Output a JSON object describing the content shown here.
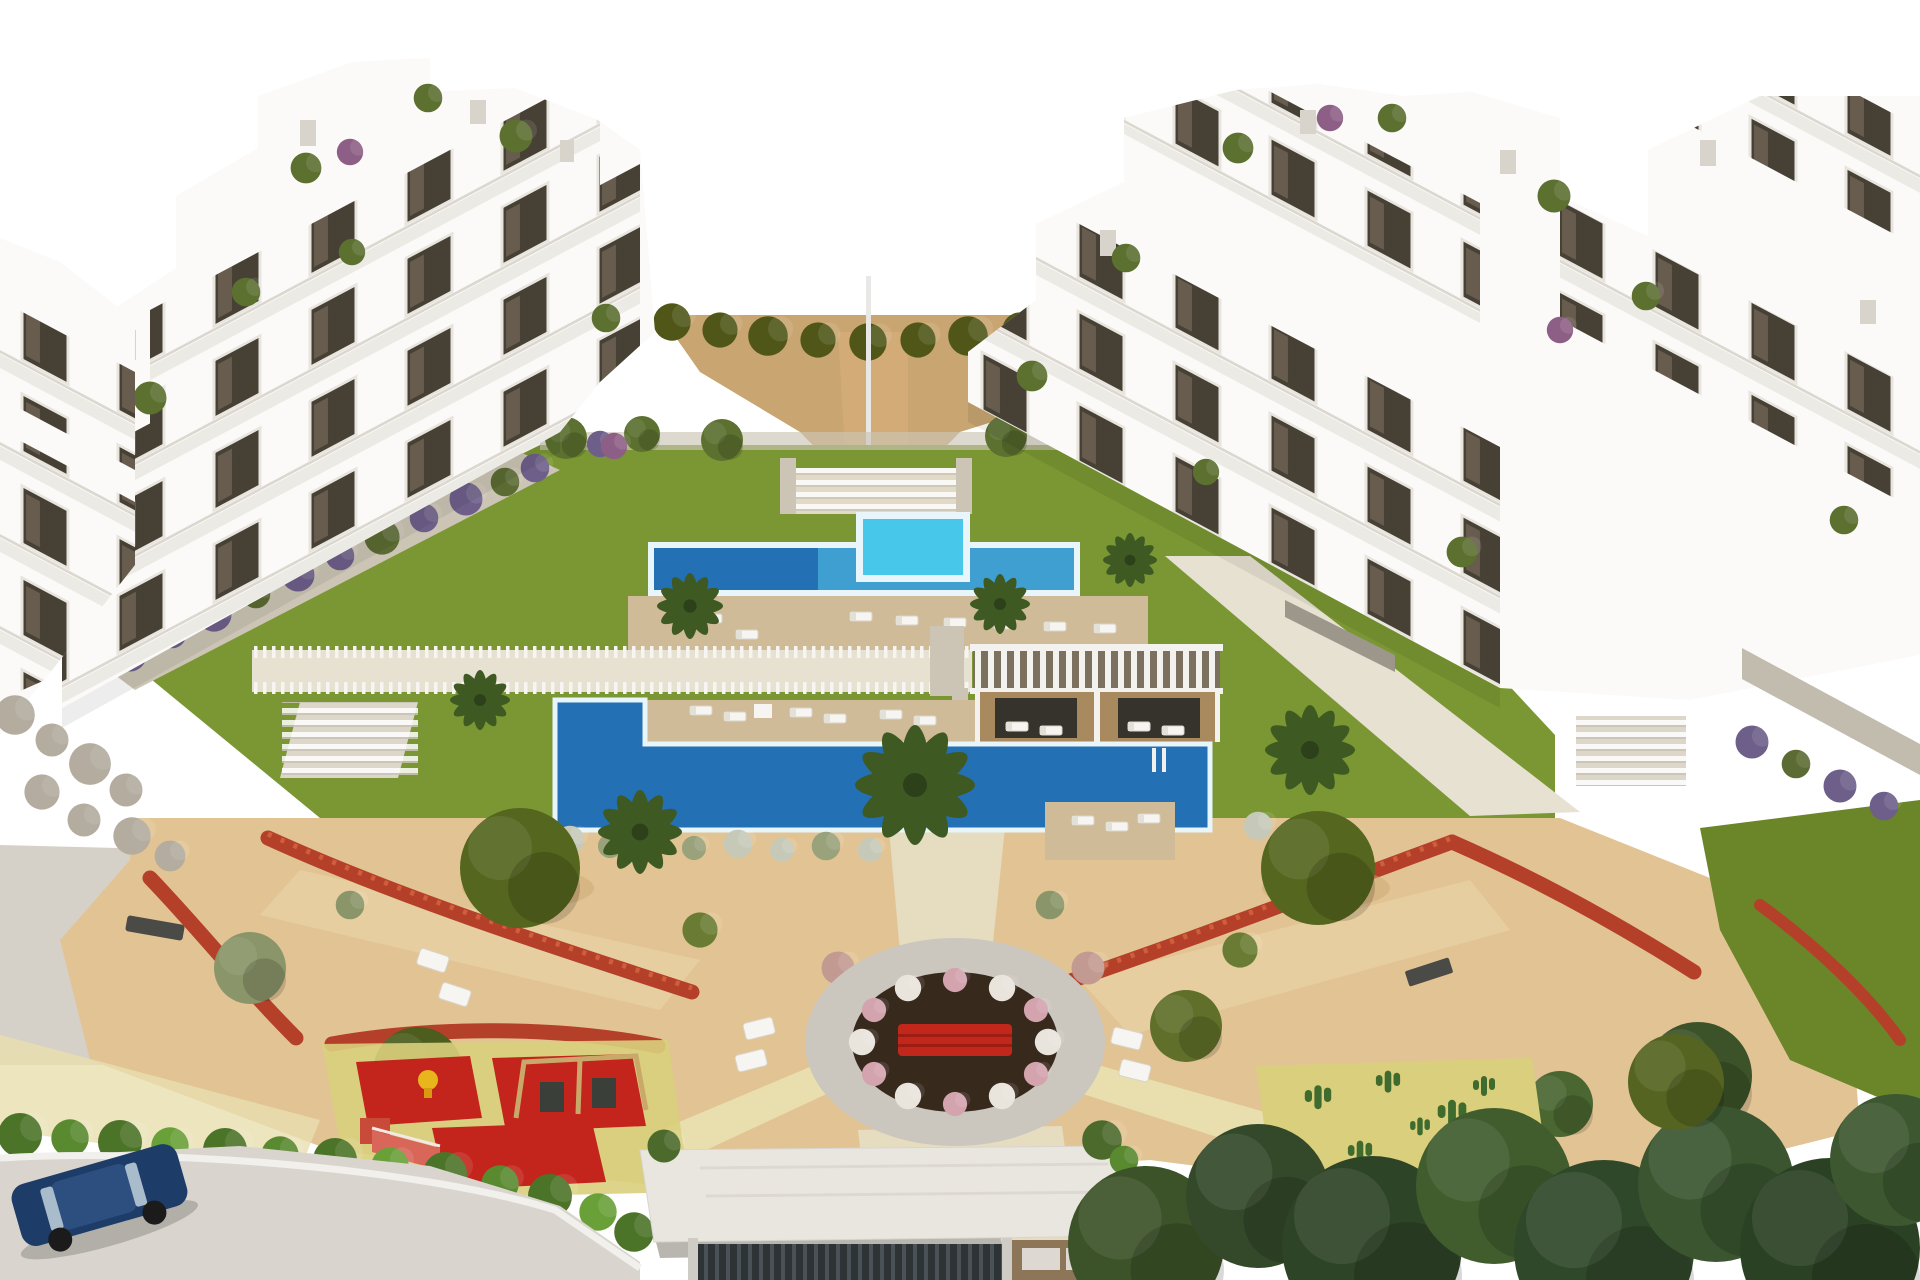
{
  "scene": {
    "type": "3d-architectural-render",
    "view": "aerial",
    "description": "Modern white apartment complex with central pool courtyard, lawns, sandy gardens, circular plaza, children playground, cactus garden, entrance gate and access road",
    "elements": [
      "left apartment building",
      "far-left apartment building",
      "right apartment building",
      "sand hill with olive hedge",
      "lap pool with raised spa",
      "sun deck with loungers",
      "white picket walkway",
      "white slatted pergola",
      "wooden cabanas",
      "main swimming pool",
      "courtyard lawn",
      "lavender hedge walls",
      "sandy park",
      "red flowering hedges",
      "olive trees",
      "palm trees",
      "circular plaza with red bench",
      "white lounge chairs",
      "children playground with red mats, swings and slide",
      "cactus garden",
      "entrance gate with white canopy",
      "access road with curb",
      "parked dark blue car",
      "bottom-right tree grove"
    ]
  },
  "palette": {
    "sky": "#ffffff",
    "building_white": "#fbfaf8",
    "building_shade": "#eceae4",
    "window_dark": "#474034",
    "sand_hill": "#c9a571",
    "hedge_olive": "#4f5618",
    "lawn_green": "#7a9733",
    "lawn_dark": "#6a8629",
    "pool_blue": "#2470b4",
    "pool_mid": "#3f9fd0",
    "spa_cyan": "#47c8ea",
    "pool_rim": "#e8f5fb",
    "deck_tan": "#cfbb97",
    "walkway_pale": "#e7e1d2",
    "stone_gray": "#ccc5b5",
    "pergola_shadow": "#7c715f",
    "slat_white": "#f4f2ee",
    "cabana_brown": "#a98a5f",
    "cabana_dark": "#35332c",
    "park_sand": "#e2c494",
    "path_cream": "#e6dcc0",
    "path_yellow": "#e9dfae",
    "red_hedge": "#b5402a",
    "tree_olive": "#55661f",
    "tree_dark": "#3c5329",
    "tree_gray": "#8a9569",
    "palm_green": "#3e5a22",
    "plaza_ring": "#cbc7bf",
    "plaza_soil": "#38291d",
    "bench_red": "#c1271a",
    "shrub_pink": "#d3a3ae",
    "shrub_white": "#e9e4dc",
    "mat_red": "#c3241c",
    "mat_yellow": "#d9cf7c",
    "cactus_green": "#3f6b2f",
    "road_gray": "#d9d5ce",
    "curb_white": "#f2f0ec",
    "pavement": "#d6d1c8",
    "car_blue": "#1e3c68",
    "car_glass": "#a9bccb",
    "lavender": "#6e5f8a",
    "gate_dark": "#2e3336",
    "gate_wall": "#8d7557",
    "rock_gray": "#b3ac9f"
  }
}
